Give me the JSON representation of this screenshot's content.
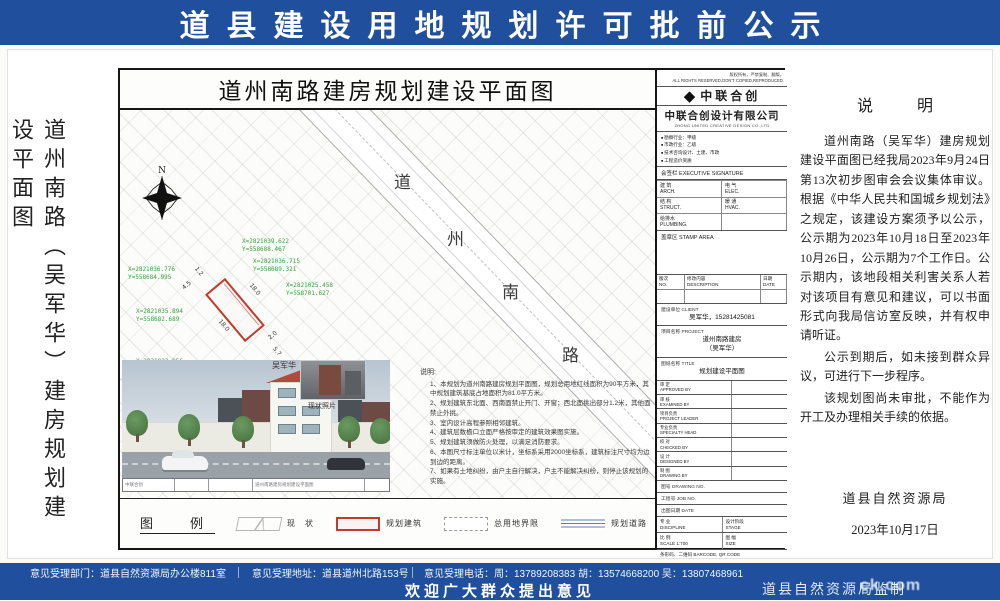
{
  "colors": {
    "banner_blue": "#1f4f9d",
    "coord_green": "#3aa03a",
    "plot_red": "#c23b2e"
  },
  "banner_top": {
    "title": "道县建设用地规划许可批前公示"
  },
  "left_title": "道州南路（吴军华）建房规划建设平面图",
  "drawing": {
    "title": "道州南路建房规划建设平面图",
    "north_label": "N",
    "road_chars": [
      "道",
      "州",
      "南",
      "路"
    ],
    "coords": [
      "X=2821039.622\nY=558688.467",
      "X=2821036.715\nY=558689.321",
      "X=2821036.776\nY=558684.995",
      "X=2821025.458\nY=558701.627",
      "X=2821035.894\nY=558682.689",
      "X=2821022.856\nY=558697.948"
    ],
    "dims": [
      "1.2",
      "4.5",
      "18.0",
      "18.0",
      "2.0",
      "5.7",
      "2.0"
    ],
    "photo": {
      "building_label": "吴军华",
      "inset_label": "现状照片"
    },
    "strip": {
      "logo": "中联合创",
      "title": "道州南路建房规划建设平面图"
    },
    "notes_title": "说明:",
    "notes": [
      "1、本规划为道州南路建房规划平面图，规划总用地红线面积为90平方米，其中规划建筑基底占地面积为81.0平方米。",
      "2、规划建筑东北面、西南面禁止开门、开窗；西北面挑出部分1.2米，其他面禁止外挑。",
      "3、室内设计高程参照相邻建筑。",
      "4、建筑层数檐口立面严格按审定的建筑效果图实施。",
      "5、规划建筑须做防火处理，以满足消防要求。",
      "6、本图尺寸标注单位以米计，坐标系采用2000坐标系，建筑标注尺寸均为边到边的距离。",
      "7、如果有土地纠纷，由户主自行解决，户主不能解决纠纷，则停止该规划的实施。"
    ],
    "legend": {
      "title": "图　例",
      "items": [
        "现　状",
        "规划建筑",
        "总用地界限",
        "规划道路",
        "坐　标"
      ]
    },
    "titleblock": {
      "copyright": "版权所有，严禁复制、翻版。\nALL RIGHTS RESERVED,DON'T COPIED,REPRODUCED.",
      "logo_text": "中联合创",
      "company_cn": "中联合创设计有限公司",
      "company_en": "ZHONG UNITED CREATIVE DESIGN CO.,LTD",
      "quals": [
        "勘察行业：甲级",
        "市政行业：乙级",
        "技术咨询设计、土建、市政",
        "工程造价资质"
      ],
      "sign_header": "会签栏 EXECUTIVE SIGNATURE",
      "sign_cells": [
        "建 筑\nARCH.",
        "电 气\nELEC.",
        "结 构\nSTRUCT.",
        "暖 通\nHVAC.",
        "给排水\nPLUMBING.",
        ""
      ],
      "stamp": "盖章区 STAMP AREA",
      "rev_headers": [
        "版次\nNO.",
        "修改内容\nDESCRIPTION",
        "日期\nDATE"
      ],
      "client_label": "建设单位 CLIENT",
      "client_value": "吴军华，15281425081",
      "project_label": "项目名称 PROJECT",
      "project_value": "道州南路建房\n（吴军华）",
      "sheet_label": "图纸名称 TITLE",
      "sheet_value": "规划建设平面图",
      "sig_rows": [
        "审 定\nAPPROVED BY",
        "审 核\nEXAMINED BY",
        "项目负责\nPROJECT LEADER",
        "专业负责\nSPECIALTY HEAD",
        "校 对\nCHECKED BY",
        "设 计\nDESIGNED BY",
        "制 图\nDRAWING BY"
      ],
      "drawing_no": "图号 DRAWING NO.",
      "job_no": "工程号 JOB NO.",
      "date_label": "出图日期 DATE",
      "discipline": "专 业\nDISCIPLINE",
      "stage": "设计阶段\nSTAGE",
      "scale": "比 例\nSCALE  1:700",
      "size": "图 幅\nSIZE",
      "barcode": "条形码、二维码 BARCODE, QR CODE"
    }
  },
  "statement": {
    "title": "说　明",
    "p1": "道州南路（吴军华）建房规划建设平面图已经我局2023年9月24日第13次初步图审会会议集体审议。根据《中华人民共和国城乡规划法》之规定，该建设方案须予以公示，公示期为2023年10月18日至2023年10月26日，公示期为7个工作日。公示期内，该地段相关利害关系人若对该项目有意见和建议，可以书面形式向我局信访室反映，并有权申请听证。",
    "p2": "公示到期后，如未接到群众异议，可进行下一步程序。",
    "p3": "该规划图尚未审批，不能作为开工及办理相关手续的依据。",
    "agency": "道县自然资源局",
    "date": "2023年10月17日"
  },
  "banner_bottom": {
    "dept": "意见受理部门：道县自然资源局办公楼811室",
    "addr": "意见受理地址：道县道州北路153号",
    "phone": "意见受理电话：周：13789208383  胡：13574668200  吴：13807468961",
    "welcome": "欢迎广大群众提出意见",
    "produced_by": "道县自然资源局监制",
    "watermark": "ck.com"
  }
}
